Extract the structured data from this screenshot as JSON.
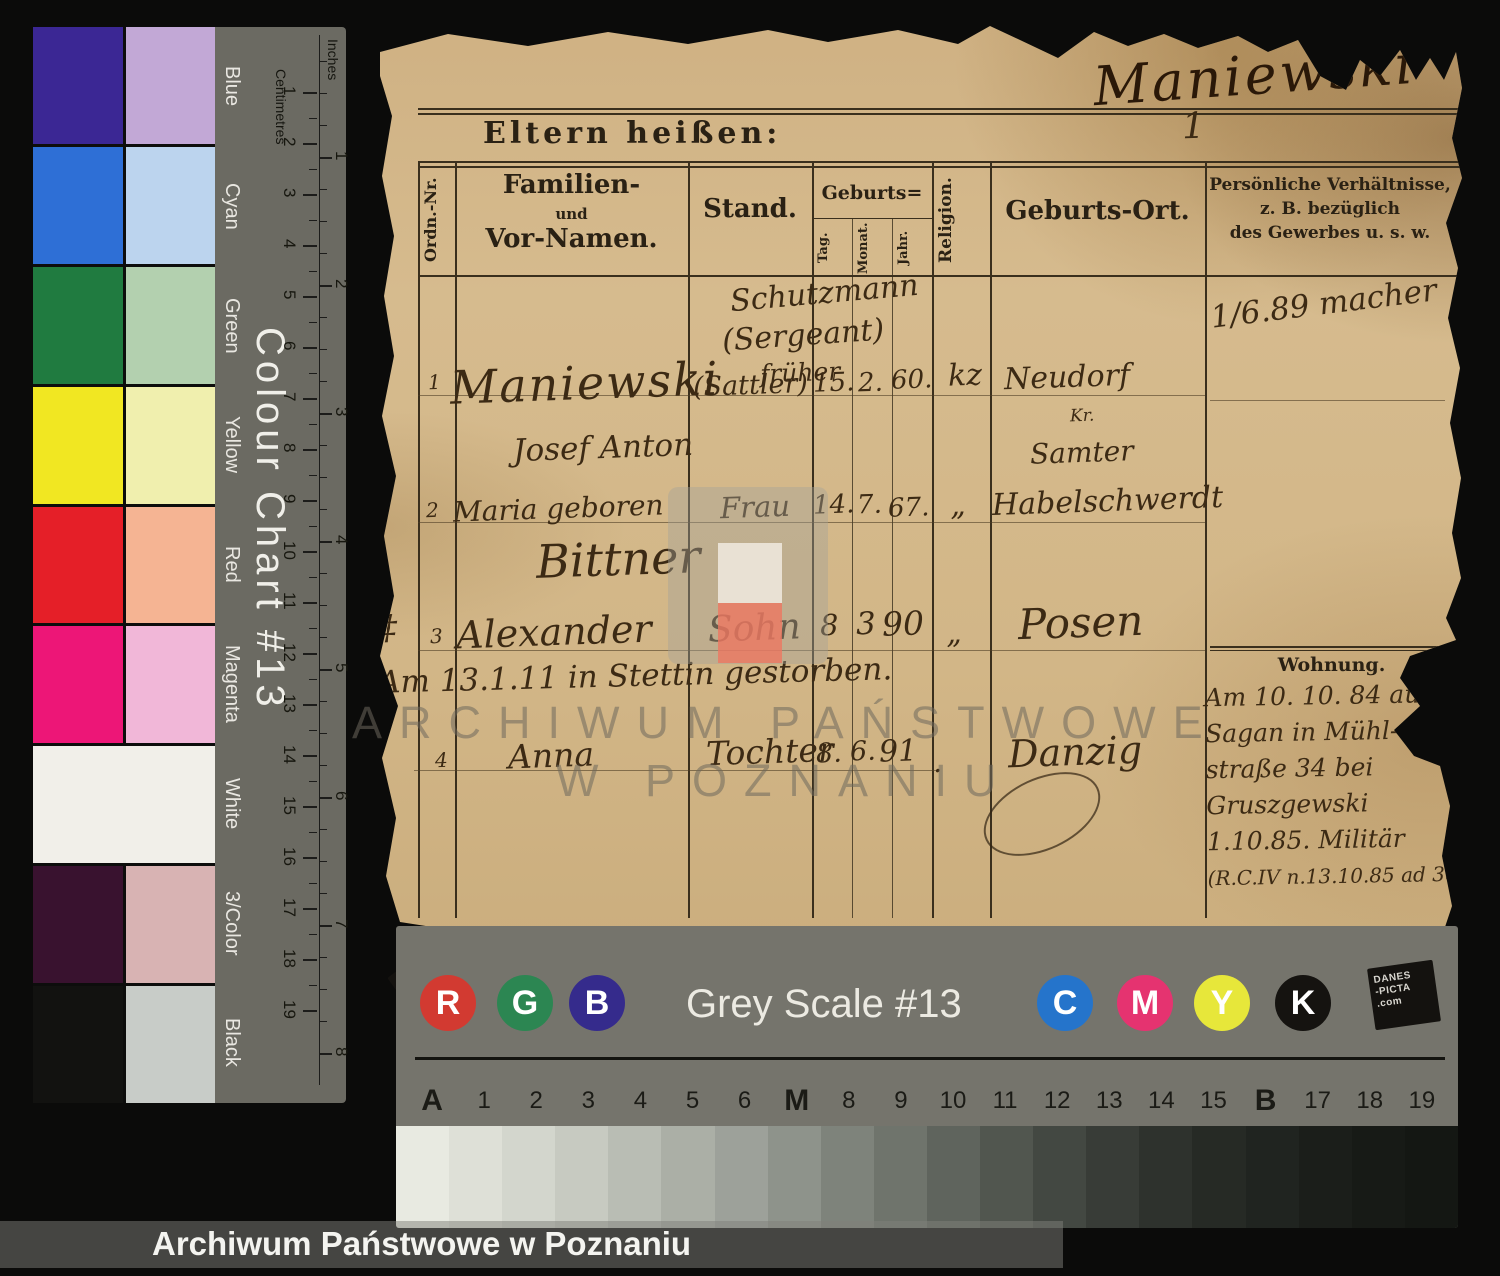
{
  "caption": "Archiwum Państwowe w Poznaniu",
  "watermark": {
    "line1": "ARCHIWUM PAŃSTWOWE",
    "line2": "W POZNANIU"
  },
  "brand": {
    "l1": "DANES",
    "l2": "-PICTA",
    "l3": ".com"
  },
  "color_chart": {
    "title": "Colour Chart #13",
    "cm_label": "Centimetres",
    "inch_label": "Inches",
    "cm_numbers": [
      1,
      2,
      3,
      4,
      5,
      6,
      7,
      8,
      9,
      10,
      11,
      12,
      13,
      14,
      15,
      16,
      17,
      18,
      19
    ],
    "inch_numbers": [
      1,
      2,
      3,
      4,
      5,
      6,
      7,
      8
    ],
    "rows": [
      {
        "label": "Blue",
        "solid": "#3b2794",
        "tint": "#c2a8d6",
        "full": false
      },
      {
        "label": "Cyan",
        "solid": "#2e6fd6",
        "tint": "#bcd4ee",
        "full": false
      },
      {
        "label": "Green",
        "solid": "#207b40",
        "tint": "#b3d0af",
        "full": false
      },
      {
        "label": "Yellow",
        "solid": "#f1e722",
        "tint": "#f0efae",
        "full": false
      },
      {
        "label": "Red",
        "solid": "#e51f28",
        "tint": "#f5b493",
        "full": false
      },
      {
        "label": "Magenta",
        "solid": "#ed1677",
        "tint": "#f1b7d8",
        "full": false
      },
      {
        "label": "White",
        "solid": "#f1efe9",
        "tint": "#f1efe9",
        "full": true
      },
      {
        "label": "3/Color",
        "solid": "#39122f",
        "tint": "#d8b3b3",
        "full": false
      },
      {
        "label": "Black",
        "solid": "#121210",
        "tint": "#c8ccc8",
        "full": false
      }
    ]
  },
  "document": {
    "top_name": "Maniewski",
    "top_mark": "1",
    "title": "Eltern heißen:",
    "table": {
      "col_ordnr": "Ordn.-Nr.",
      "col_name_l1": "Familien-",
      "col_name_l2": "und",
      "col_name_l3": "Vor-Namen.",
      "col_stand": "Stand.",
      "col_geburts": "Geburts=",
      "col_tag": "Tag.",
      "col_monat": "Monat.",
      "col_jahr": "Jahr.",
      "col_religion": "Religion.",
      "col_ort": "Geburts-Ort.",
      "col_pers_l1": "Persönliche Verhältnisse,",
      "col_pers_l2": "z. B. bezüglich",
      "col_pers_l3": "des Gewerbes u. s. w."
    },
    "entries": {
      "pers_note": "1/6.89 macher",
      "stand_l1": "Schutzmann",
      "stand_l2": "(Sergeant)",
      "stand_l3": "früher",
      "rows": [
        {
          "nr": "1",
          "name_l1": "Maniewski",
          "name_l2": "Josef Anton",
          "stand": "(Sattler)",
          "tag": "15.",
          "monat": "2.",
          "jahr": "60.",
          "religion": "kz",
          "ort_l1": "Neudorf",
          "ort_l2": "Kr.",
          "ort_l3": "Samter"
        },
        {
          "nr": "2",
          "name_l1": "Maria geboren",
          "name_l2": "Bittner",
          "stand": "Frau",
          "tag": "14.",
          "monat": "7.",
          "jahr": "67.",
          "religion": "„",
          "ort_l1": "Habelschwerdt"
        },
        {
          "nr": "3",
          "nr_prefix": "‡",
          "name_l1": "Alexander",
          "stand": "Sohn",
          "tag": "8",
          "monat": "3",
          "jahr": "90",
          "religion": "„",
          "ort_l1": "Posen",
          "note": "Am 13.1.11 in Stettin gestorben."
        },
        {
          "nr": "4",
          "name_l1": "Anna",
          "stand": "Tochter",
          "tag": "8.",
          "monat": "6.",
          "jahr": "91",
          "religion": ".",
          "ort_l1": "Danzig"
        }
      ],
      "wohnung_header": "Wohnung.",
      "wohnung_lines": [
        "Am 10. 10. 84 aus",
        "Sagan in Mühl-",
        "straße 34 bei",
        "Gruszgewski",
        "1.10.85. Militär",
        "(R.C.IV n.13.10.85 ad 3057/85"
      ]
    }
  },
  "grey_scale": {
    "title": "Grey Scale #13",
    "rgb_dots": [
      {
        "letter": "R",
        "color": "#d23a31"
      },
      {
        "letter": "G",
        "color": "#2c8652"
      },
      {
        "letter": "B",
        "color": "#352b8c"
      }
    ],
    "cmyk_dots": [
      {
        "letter": "C",
        "color": "#2574cb"
      },
      {
        "letter": "M",
        "color": "#e53370"
      },
      {
        "letter": "Y",
        "color": "#e7e73a"
      },
      {
        "letter": "K",
        "color": "#151310"
      }
    ],
    "labels": [
      "A",
      "1",
      "2",
      "3",
      "4",
      "5",
      "6",
      "M",
      "8",
      "9",
      "10",
      "11",
      "12",
      "13",
      "14",
      "15",
      "B",
      "17",
      "18",
      "19"
    ],
    "patches": [
      "#e8eae1",
      "#dee0d7",
      "#d3d6cd",
      "#c7cac1",
      "#b9bdb4",
      "#abafa6",
      "#9da19a",
      "#8e938b",
      "#7e837b",
      "#6f746c",
      "#5f645d",
      "#51564f",
      "#434842",
      "#383c37",
      "#2e322d",
      "#262a25",
      "#202420",
      "#1b1e1a",
      "#171a16",
      "#141713"
    ]
  }
}
